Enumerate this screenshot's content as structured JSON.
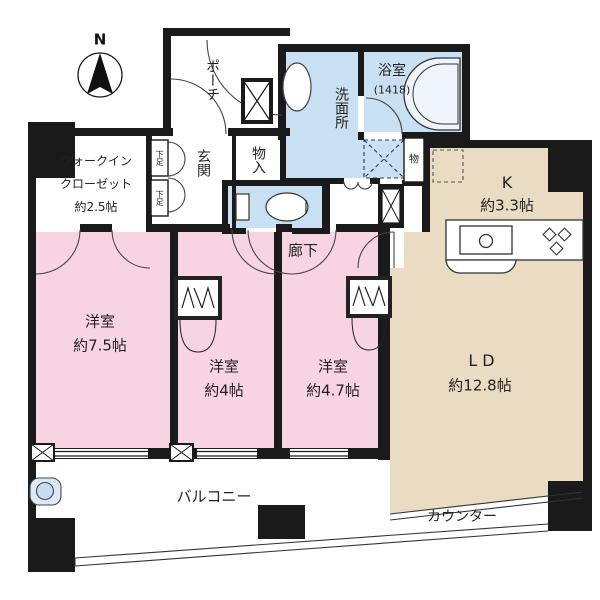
{
  "plan": {
    "compass": {
      "label": "N"
    },
    "rooms": {
      "porch": {
        "label": "ポーチ"
      },
      "wic": {
        "line1": "ウォークイン",
        "line2": "クローゼット",
        "line3": "約2.5帖"
      },
      "genkan": {
        "label": "玄関"
      },
      "shoe_upper": {
        "label": "下足"
      },
      "shoe_lower": {
        "label": "下足"
      },
      "mono_ire": {
        "label": "物入"
      },
      "washroom": {
        "label": "洗面所"
      },
      "bathroom": {
        "label": "浴室",
        "size": "(1418)"
      },
      "mono": {
        "label": "物"
      },
      "corridor": {
        "label": "廊下"
      },
      "kitchen": {
        "label": "K",
        "size": "約3.3帖"
      },
      "living": {
        "label": "LD",
        "size": "約12.8帖"
      },
      "bedroom1": {
        "label": "洋室",
        "size": "約7.5帖"
      },
      "bedroom2": {
        "label": "洋室",
        "size": "約4帖"
      },
      "bedroom3": {
        "label": "洋室",
        "size": "約4.7帖"
      },
      "balcony": {
        "label": "バルコニー"
      },
      "counter": {
        "label": "カウンター"
      }
    },
    "colors": {
      "bedroom": "#F8D3E1",
      "wet": "#C9E0F3",
      "living": "#EADCC2",
      "wall": "#1a1a1a"
    }
  }
}
